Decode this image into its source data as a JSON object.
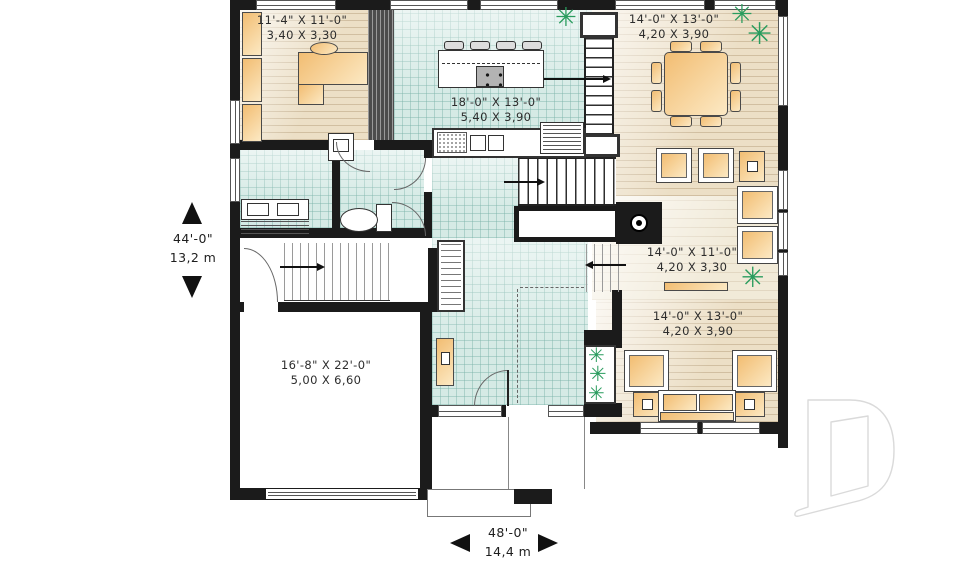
{
  "plan_type": "first-floor-plan",
  "rooms": [
    {
      "key": "office",
      "imperial": "11'-4\" X 11'-0\"",
      "metric": "3,40 X 3,30"
    },
    {
      "key": "kitchen",
      "imperial": "18'-0\" X 13'-0\"",
      "metric": "5,40 X 3,90"
    },
    {
      "key": "dining",
      "imperial": "14'-0\" X 13'-0\"",
      "metric": "4,20 X 3,90"
    },
    {
      "key": "living",
      "imperial": "14'-0\" X 11'-0\"",
      "metric": "4,20 X 3,30"
    },
    {
      "key": "family",
      "imperial": "14'-0\" X 13'-0\"",
      "metric": "4,20 X 3,90"
    },
    {
      "key": "garage",
      "imperial": "16'-8\" X 22'-0\"",
      "metric": "5,00 X 6,60"
    }
  ],
  "overall_dimensions": {
    "depth": {
      "imperial": "44'-0\"",
      "metric": "13,2 m"
    },
    "width": {
      "imperial": "48'-0\"",
      "metric": "14,4 m"
    }
  },
  "colors": {
    "wall": "#1b1b1b",
    "tile_floor": "#d5eae5",
    "wood_floor": "#ecdfc6",
    "furniture_tan": "#f2bd72",
    "plant_green": "#2a9c5e",
    "watermark_outline": "#d9d9d9",
    "text": "#2d2d2d"
  },
  "icons": {
    "plants": "plant-icon",
    "fireplace": "fireplace-icon",
    "stair_arrows": "direction-arrow-icon",
    "watermark": "drummond-d-logo"
  }
}
